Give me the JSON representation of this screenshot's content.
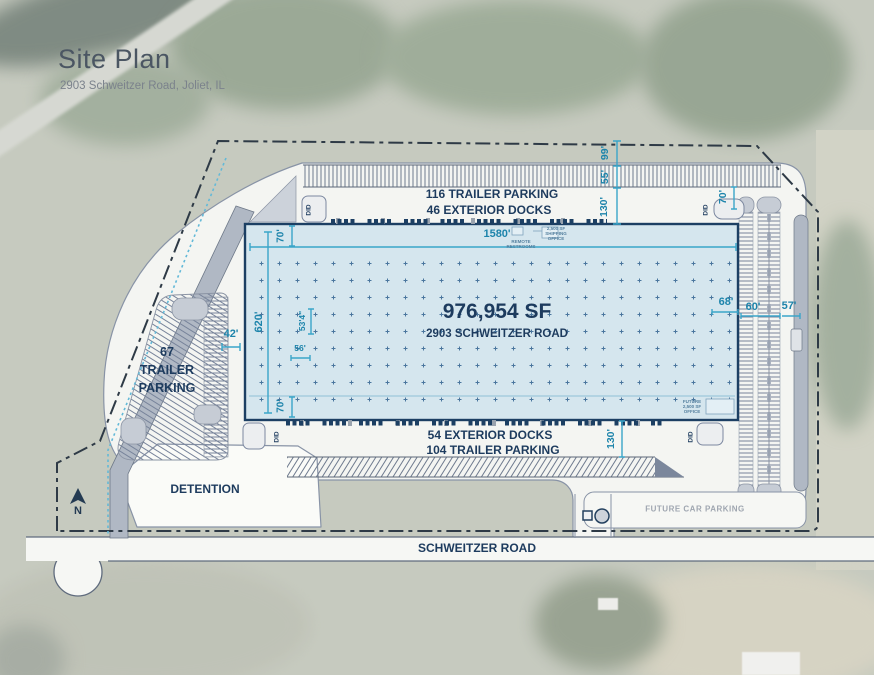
{
  "header": {
    "title": "Site Plan",
    "subtitle": "2903 Schweitzer Road, Joliet, IL"
  },
  "building": {
    "area": "976,954 SF",
    "address": "2903 SCHWEITZER ROAD",
    "remote_restrooms": "REMOTE RESTROOMS",
    "shipping_office": "2,500 SF SHIPPING OFFICE",
    "future_office": "FUTURE 2,500 SF OFFICE"
  },
  "site_labels": {
    "north_trailer_parking": "116 TRAILER PARKING",
    "north_docks": "46 EXTERIOR DOCKS",
    "south_docks": "54 EXTERIOR DOCKS",
    "south_trailer_parking": "104 TRAILER PARKING",
    "west_trailer_line1": "67",
    "west_trailer_line2": "TRAILER",
    "west_trailer_line3": "PARKING",
    "detention": "DETENTION",
    "road_name": "SCHWEITZER ROAD",
    "future_car_parking": "FUTURE CAR PARKING",
    "north_marker": "N",
    "drive_in_door": "DID"
  },
  "dimensions": {
    "building_length": "1580'",
    "building_depth": "620'",
    "north_speed_bay": "70'",
    "south_speed_bay": "70'",
    "column_bay_depth": "53'4\"",
    "column_bay_width": "56'",
    "west_drive_width": "42'",
    "north_setback": "99'",
    "north_trailer_depth": "55'",
    "north_truck_court": "130'",
    "northeast_drive": "70'",
    "south_truck_court": "130'",
    "east_speed_bay": "68'",
    "east_parking_depth": "60'",
    "east_drive_width": "57'"
  },
  "colors": {
    "building_fill": "#d5e6ee",
    "building_border": "#1c3f63",
    "label_navy": "#1d3b5e",
    "dimension_blue": "#1d84ab",
    "boundary": "#2e3a46",
    "paving": "#f4f5f2"
  }
}
